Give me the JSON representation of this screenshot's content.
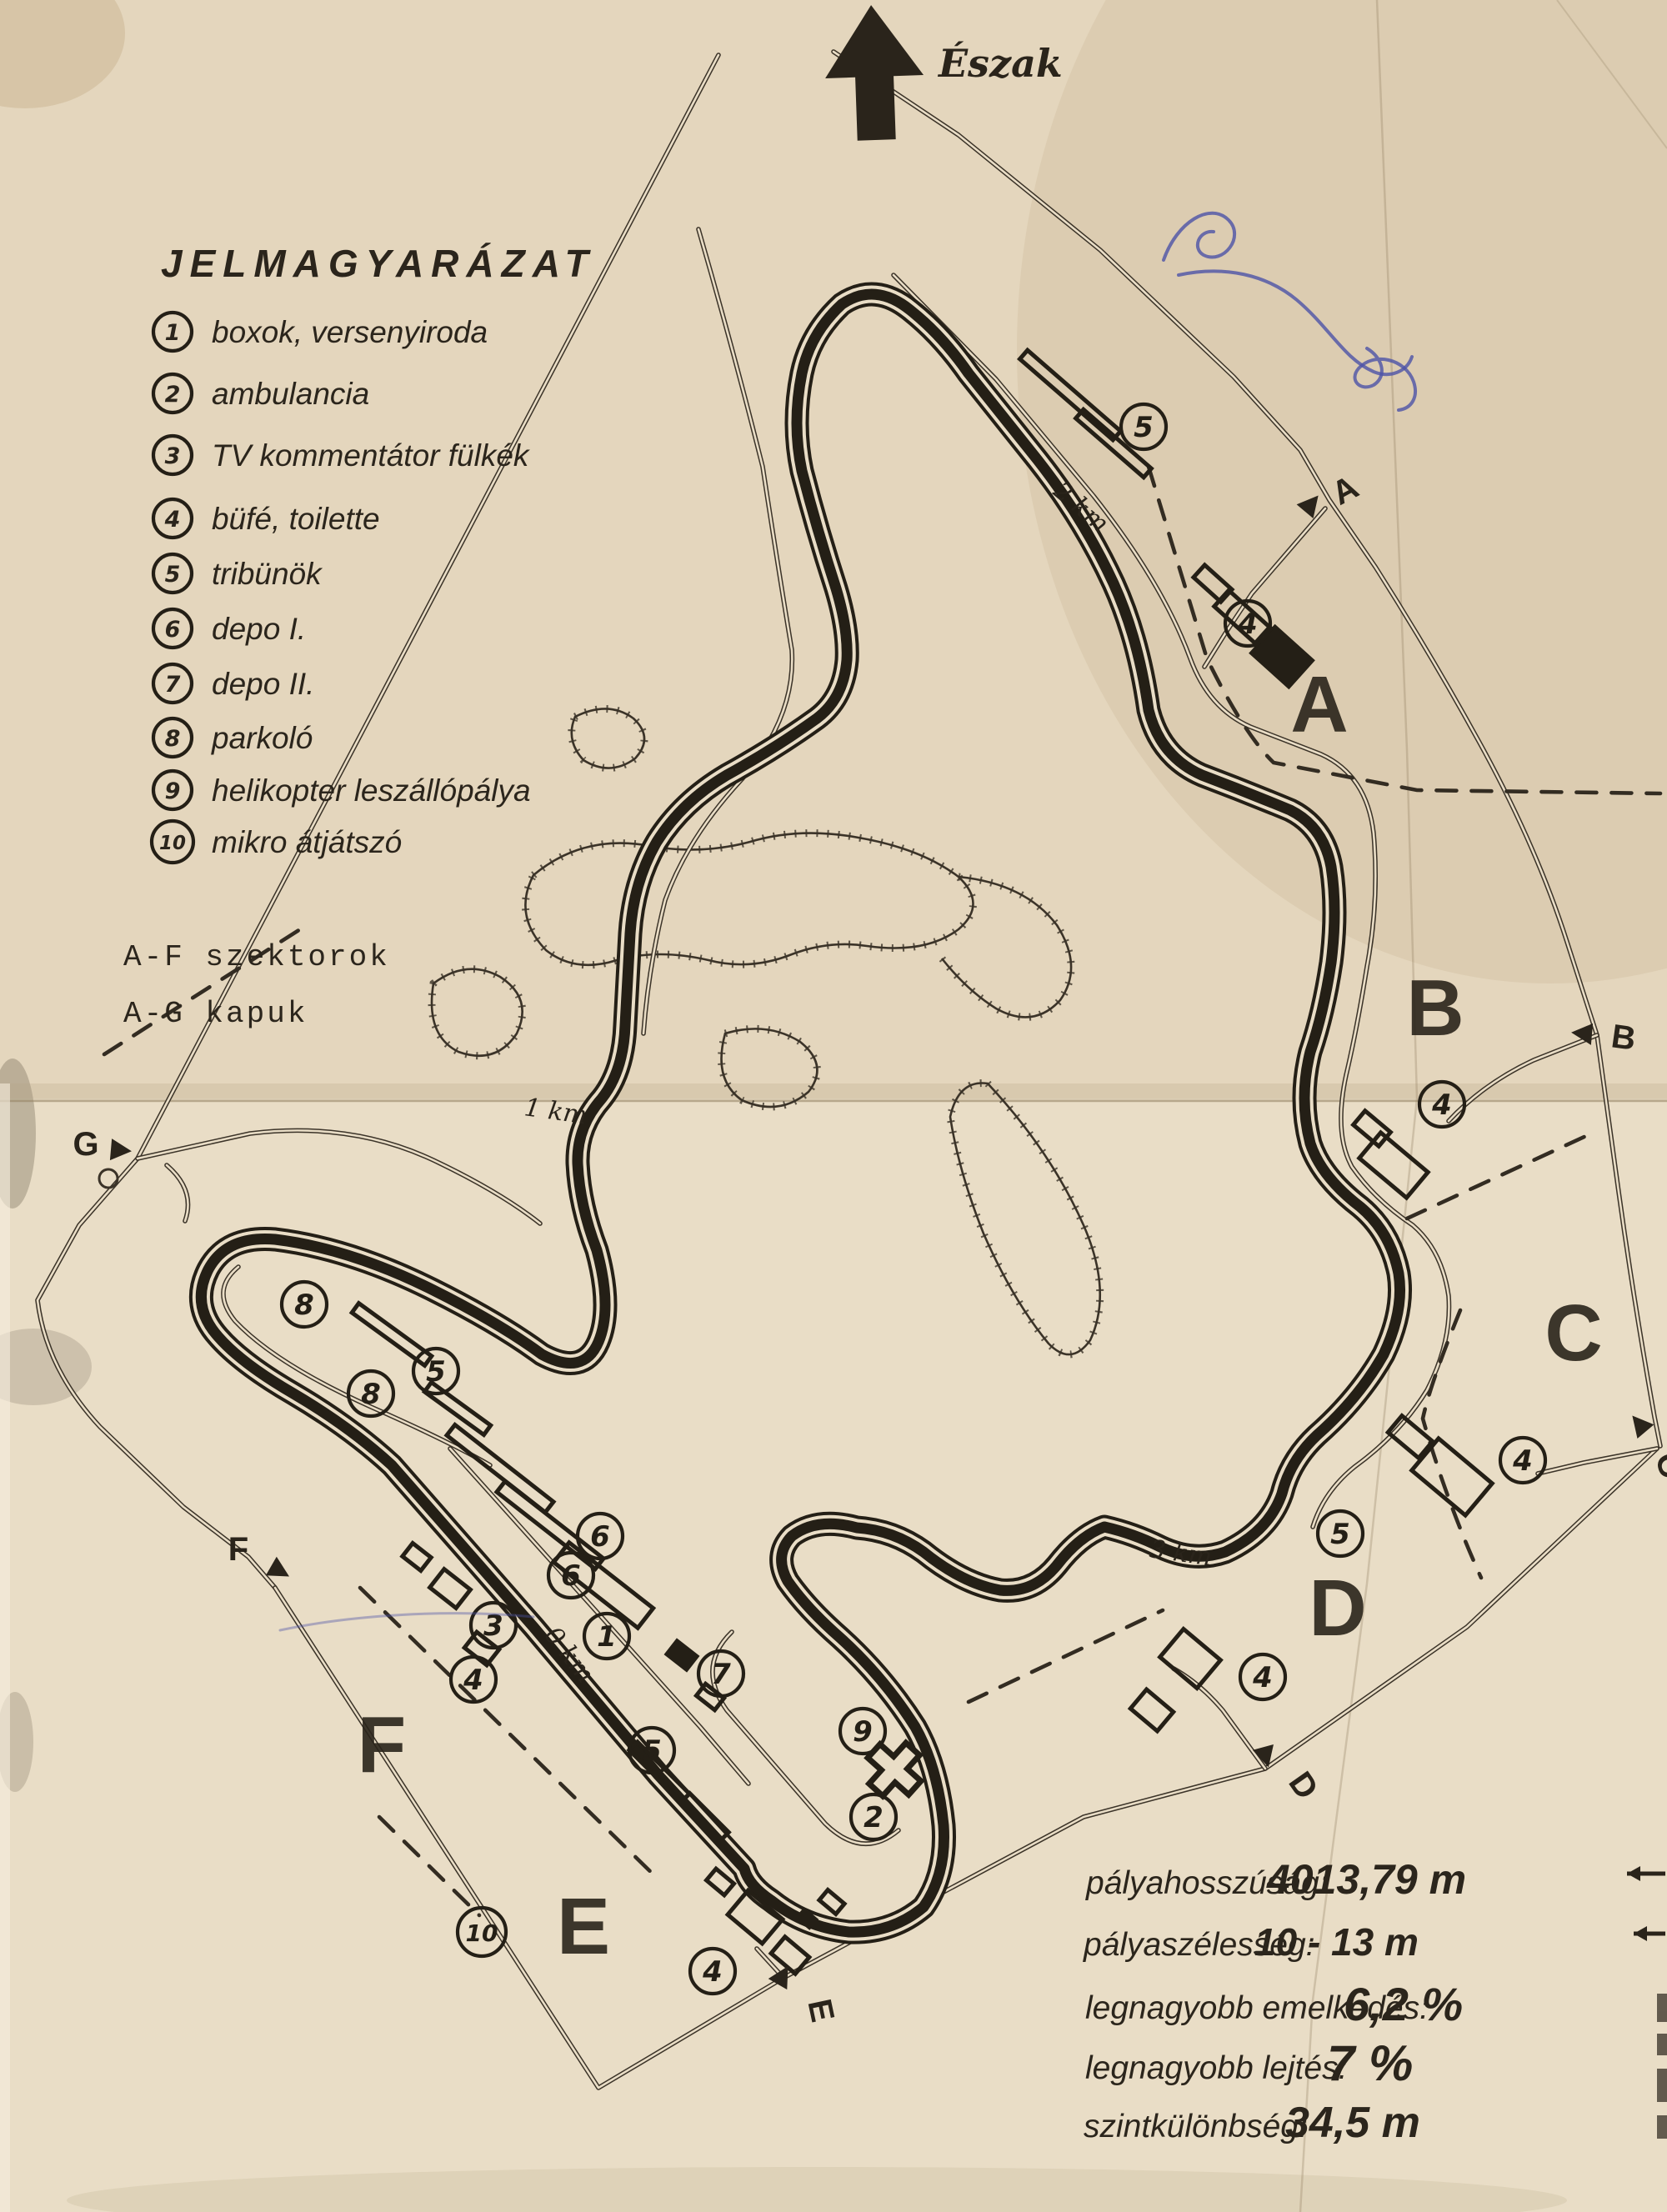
{
  "map": {
    "title_hint": "Hungaroring pálya-térkép (scan)",
    "colors": {
      "paper": "#e9ddc6",
      "ink": "#2a241c",
      "blue_ink": "#4c52a8"
    },
    "north_label": "Észak",
    "legend": {
      "title": "JELMAGYARÁZAT",
      "items": [
        {
          "num": "1",
          "label": "boxok, versenyiroda"
        },
        {
          "num": "2",
          "label": "ambulancia"
        },
        {
          "num": "3",
          "label": "TV kommentátor fülkék"
        },
        {
          "num": "4",
          "label": "büfé, toilette"
        },
        {
          "num": "5",
          "label": "tribünök"
        },
        {
          "num": "6",
          "label": "depo I."
        },
        {
          "num": "7",
          "label": "depo II."
        },
        {
          "num": "8",
          "label": "parkoló"
        },
        {
          "num": "9",
          "label": "helikopter leszállópálya"
        },
        {
          "num": "10",
          "label": "mikro átjátszó"
        }
      ],
      "extra": [
        "A-F szektorok",
        "A-G kapuk"
      ]
    },
    "stats": [
      {
        "label": "pályahosszúság:",
        "value": "4013,79 m"
      },
      {
        "label": "pályaszélesség:",
        "value": "10 - 13 m"
      },
      {
        "label": "legnagyobb emelkedés:",
        "value": "6,2 %"
      },
      {
        "label": "legnagyobb lejtés:",
        "value": "7 %"
      },
      {
        "label": "szintkülönbség:",
        "value": "34,5 m"
      }
    ],
    "sectors": [
      "A",
      "B",
      "C",
      "D",
      "E",
      "F"
    ],
    "gates": [
      "A",
      "B",
      "C",
      "D",
      "E",
      "F",
      "G"
    ],
    "km_markers": [
      "0 km",
      "1 km",
      "2 km",
      "3 km"
    ],
    "point_markers": [
      {
        "n": "5"
      },
      {
        "n": "4"
      },
      {
        "n": "4"
      },
      {
        "n": "4"
      },
      {
        "n": "5"
      },
      {
        "n": "4"
      },
      {
        "n": "8"
      },
      {
        "n": "8"
      },
      {
        "n": "5"
      },
      {
        "n": "6"
      },
      {
        "n": "6"
      },
      {
        "n": "1"
      },
      {
        "n": "3"
      },
      {
        "n": "4"
      },
      {
        "n": "7"
      },
      {
        "n": "9"
      },
      {
        "n": "2"
      },
      {
        "n": "5"
      },
      {
        "n": "10"
      },
      {
        "n": "4"
      }
    ]
  }
}
